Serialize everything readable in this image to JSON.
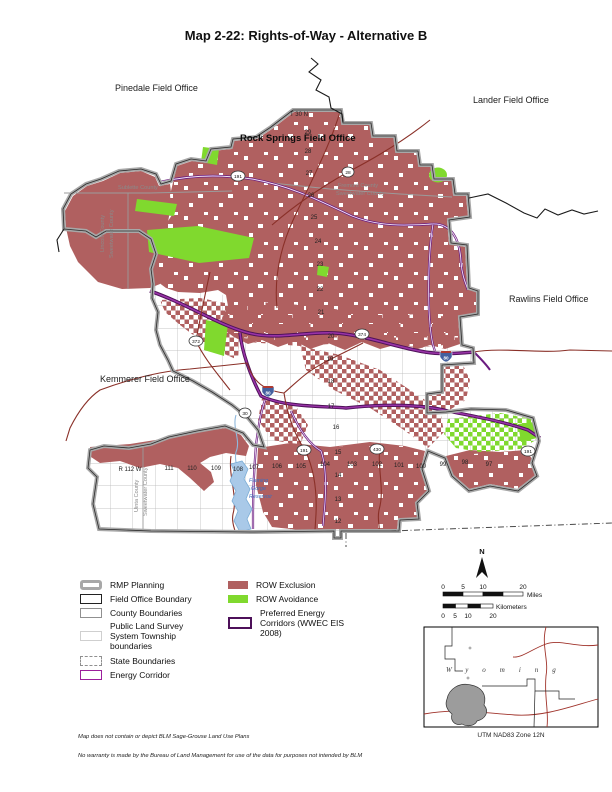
{
  "title": "Map 2-22: Rights-of-Way - Alternative B",
  "map": {
    "labels": {
      "pinedale": "Pinedale Field Office",
      "lander": "Lander Field Office",
      "rock_springs": "Rock Springs Field Office",
      "rawlins": "Rawlins Field Office",
      "kemmerer": "Kemmerer Field Office",
      "sublette_county": "Sublette County",
      "lincoln_county": "Lincoln County",
      "sweetwater_county_w": "Sweetwater County",
      "fremont_county": "Fremont County",
      "sweetwater_county_n": "Sweetwater County",
      "uinta_county": "Uinta County",
      "sweetwater_county_s": "Sweetwater County",
      "reservoir_line1": "Flaming",
      "reservoir_line2": "Gorge",
      "reservoir_line3": "Reservoir"
    },
    "townships": [
      "T 30 N",
      "29",
      "28",
      "27",
      "26",
      "25",
      "24",
      "23",
      "22",
      "21",
      "20",
      "19",
      "18",
      "17",
      "16",
      "15",
      "14",
      "13",
      "12"
    ],
    "ranges": [
      "R 112 W",
      "111",
      "110",
      "109",
      "108",
      "107",
      "106",
      "105",
      "104",
      "103",
      "102",
      "101",
      "100",
      "99",
      "98",
      "97"
    ],
    "shields": {
      "s1": "191",
      "s2": "28",
      "s3": "372",
      "s4": "374",
      "s5": "30",
      "s6": "191",
      "s7": "430",
      "s8": "191",
      "i1": "80",
      "i2": "80"
    }
  },
  "north": {
    "label": "N"
  },
  "scalebar": {
    "miles": {
      "t0": "0",
      "t5": "5",
      "t10": "10",
      "t20": "20",
      "unit": "Miles"
    },
    "km": {
      "t0": "0",
      "t5": "5",
      "t10": "10",
      "t20": "20",
      "unit": "Kilometers"
    }
  },
  "inset": {
    "state": "Wyoming",
    "caption": "UTM NAD83 Zone 12N"
  },
  "legend": {
    "items_left": [
      {
        "label": "RMP Planning"
      },
      {
        "label": "Field Office Boundary"
      },
      {
        "label": "County Boundaries"
      },
      {
        "label": "Public Land Survey\nSystem Township\nboundaries"
      },
      {
        "label": "State Boundaries"
      },
      {
        "label": "Energy Corridor"
      }
    ],
    "items_right": [
      {
        "label": "ROW Exclusion"
      },
      {
        "label": "ROW Avoidance"
      },
      {
        "label": "Preferred Energy\nCorridors (WWEC EIS\n2008)"
      }
    ]
  },
  "colors": {
    "row_exclusion": "#b06060",
    "row_avoidance": "#80d92e",
    "energy_corridor": "#9c1f9c",
    "preferred_corridor": "#4d1059",
    "rmp_boundary": "#a8a8a8",
    "water": "#a9c9e8"
  },
  "notes": [
    "Map does not contain or depict BLM Sage-Grouse Land Use Plans",
    "No warranty is made by the Bureau of Land Management for use of the data for purposes not intended by BLM"
  ]
}
